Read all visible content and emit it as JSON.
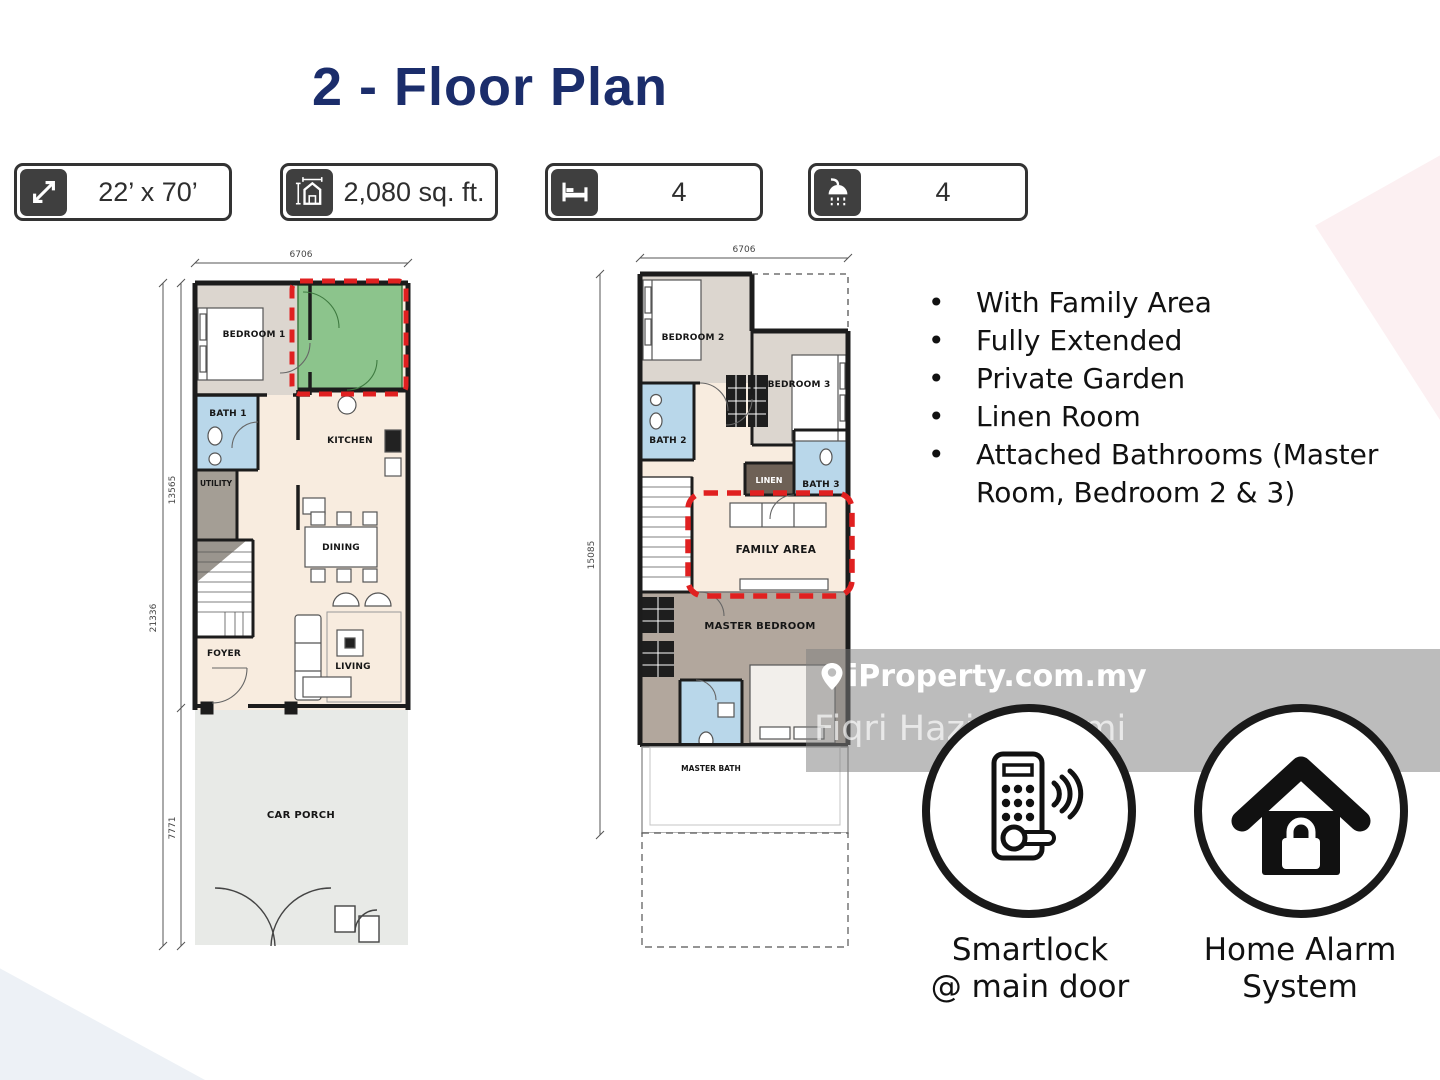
{
  "slide": {
    "title": "2 - Floor Plan"
  },
  "badges": [
    {
      "icon": "diagonal-arrow-icon",
      "label": "22’ x 70’"
    },
    {
      "icon": "floor-area-icon",
      "label": "2,080 sq. ft."
    },
    {
      "icon": "bed-icon",
      "label": "4"
    },
    {
      "icon": "shower-icon",
      "label": "4"
    }
  ],
  "features": {
    "items": [
      "With Family Area",
      "Fully Extended",
      "Private Garden",
      "Linen Room",
      "Attached Bathrooms (Master Room, Bedroom 2 & 3)"
    ]
  },
  "plans": {
    "ground": {
      "top_dim": "6706",
      "side_dims": {
        "upper": "13565",
        "total": "21336",
        "porch": "7771"
      },
      "rooms": {
        "bedroom1": "BEDROOM 1",
        "bath1": "BATH 1",
        "utility": "UTILITY",
        "kitchen": "KITCHEN",
        "dining": "DINING",
        "foyer": "FOYER",
        "living": "LIVING",
        "car_porch": "CAR PORCH"
      }
    },
    "first": {
      "top_dim": "6706",
      "side_dim": "15085",
      "rooms": {
        "bedroom2": "BEDROOM 2",
        "bedroom3": "BEDROOM 3",
        "bath2": "BATH 2",
        "bath3": "BATH 3",
        "linen": "LINEN",
        "family": "FAMILY AREA",
        "master_bedroom": "MASTER BEDROOM",
        "master_bath": "MASTER BATH"
      }
    }
  },
  "security": [
    {
      "icon": "smartlock-icon",
      "line1": "Smartlock",
      "line2": "@ main door"
    },
    {
      "icon": "home-alarm-icon",
      "line1": "Home Alarm",
      "line2": "System"
    }
  ],
  "watermark": {
    "brand": "iProperty.com.my",
    "agent": "Fiqri Hazim Rozmi"
  },
  "colors": {
    "title_navy": "#1b2d6b",
    "accent_red": "#e02020",
    "highlight_green": "#8cc48c",
    "green_border": "#3e7a40",
    "bath_blue": "#b9d7ea",
    "bedroom_gray": "#dcd6cf",
    "floor_beige": "#f8ecdf",
    "family_beige": "#f9ecdf",
    "master_brown": "#b2a79d",
    "linen_brown": "#6e6156",
    "utility_gray": "#a49e95",
    "porch_gray": "#e8eae7",
    "wall_black": "#1c1c1c",
    "badge_dark": "#3f3f3f"
  }
}
